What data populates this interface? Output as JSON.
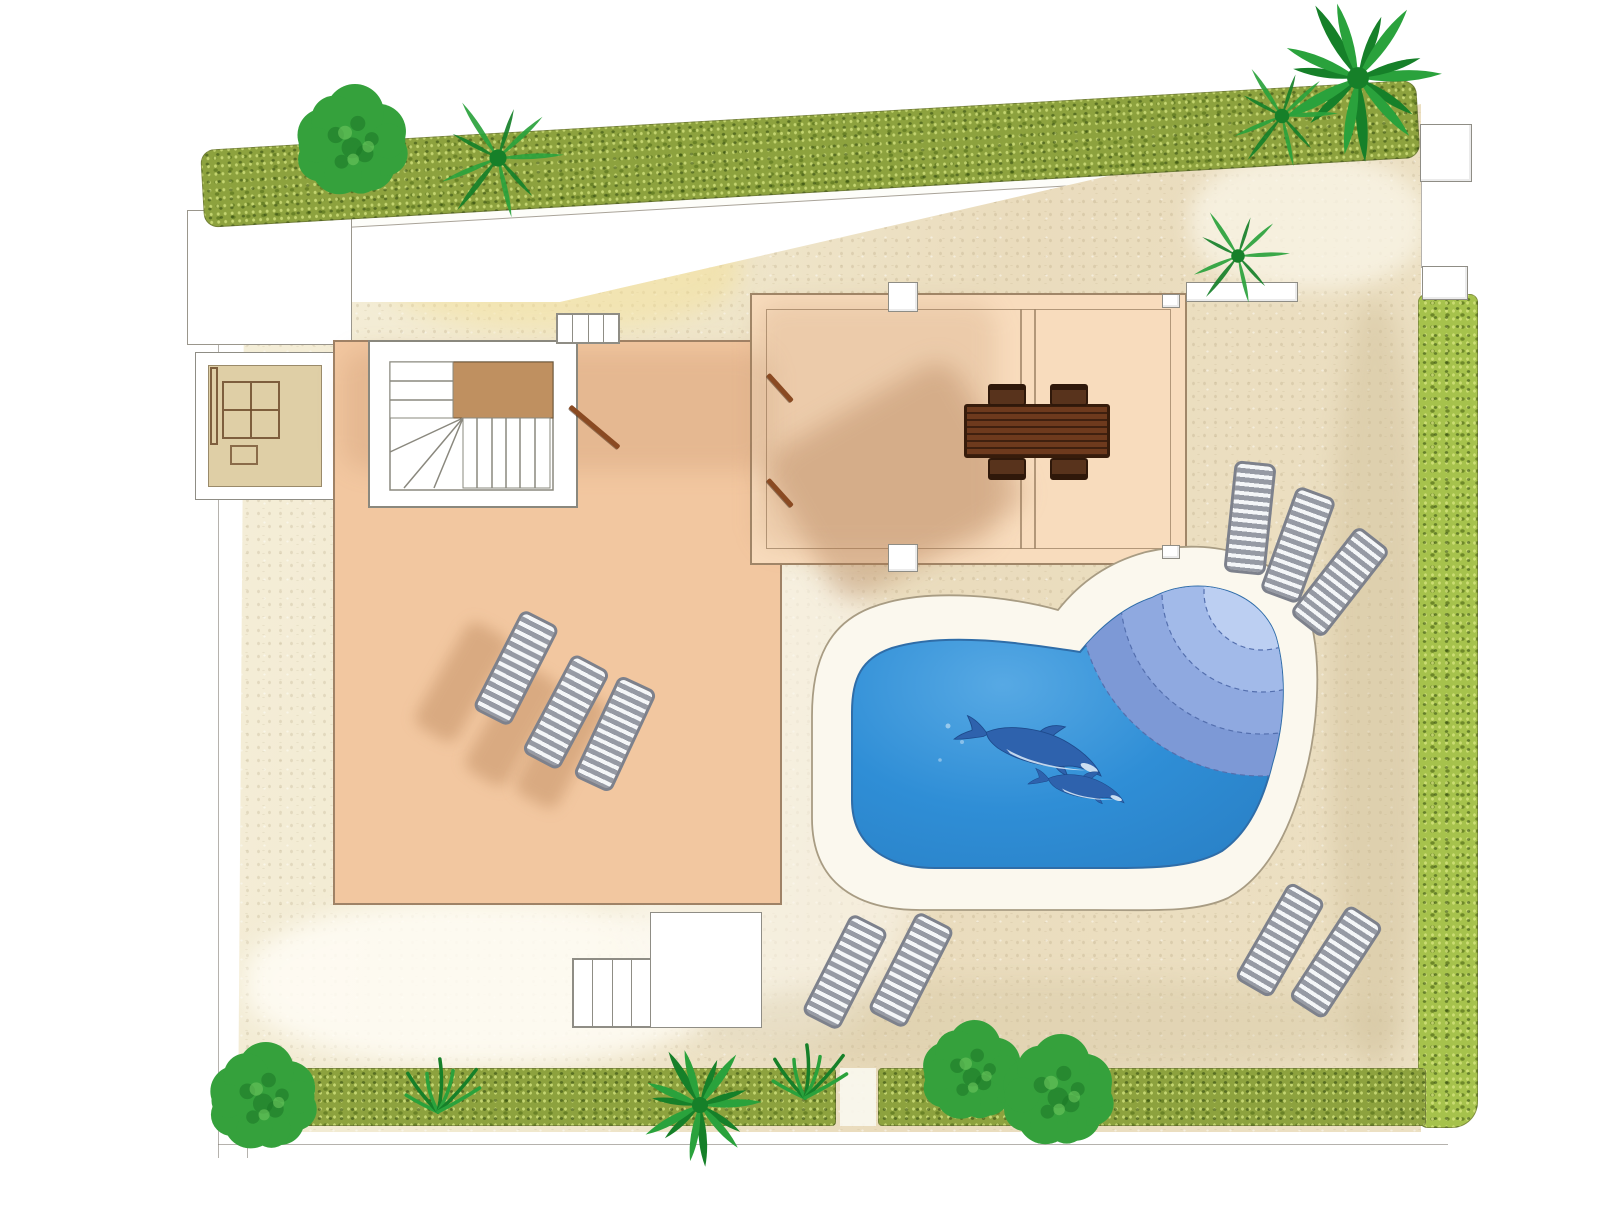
{
  "meta": {
    "view": "top-down-garden-plan",
    "text_labels": []
  },
  "colors": {
    "page": "#ffffff",
    "outline": "#8f8d85",
    "ground_light": "#f6f0dc",
    "ground_tan": "#e9dcbb",
    "terrace": "#f2c7a0",
    "pergola_floor": "#f8dcbd",
    "patio": "#ffffff",
    "stair_landing": "#bf9060",
    "bbq_interior": "#dfcfa6",
    "bbq_brown": "#6d4a2a",
    "pool_deck": "#fbf8ee",
    "pool_water": "#2f8ed6",
    "pool_water_light": "#57a9e4",
    "pool_edge": "#2f6da8",
    "step_arc_outer": "#7d99d6",
    "step_arc_2": "#8fa9e0",
    "step_arc_3": "#a2bae9",
    "step_arc_inner": "#bccff2",
    "dolphin": "#2e62ad",
    "dolphin_light": "#ddecf8",
    "hedge_olive": "#8da23e",
    "hedge_bright": "#a6c24c",
    "tree": "#35a13c",
    "tree_dark": "#1c7626",
    "tree_light": "#6cc65e",
    "palm": "#2aa23c",
    "palm_dark": "#168029",
    "lounger": "#969aa4",
    "lounger_stripe": "#f4f6f8",
    "table_wood": "#6e3a1d",
    "chair_wood": "#58331c",
    "shadow": "rgba(172,118,76,0.33)"
  },
  "scene": {
    "boundary_lines": [
      {
        "name": "boundary-left-outer",
        "x": 218,
        "y": 212,
        "w": 1,
        "h": 946
      },
      {
        "name": "boundary-left-inner",
        "x": 247,
        "y": 212,
        "w": 1,
        "h": 946
      },
      {
        "name": "boundary-bottom",
        "x": 218,
        "y": 1144,
        "w": 1230,
        "h": 1
      },
      {
        "name": "boundary-right-gate",
        "x": 1421,
        "y": 182,
        "w": 1,
        "h": 86
      }
    ],
    "hedges": [
      {
        "name": "hedge-north",
        "x": 200,
        "y": 150,
        "w": 1218,
        "h": 78,
        "rot": -3.3,
        "variant": "olive",
        "radius": "14px"
      },
      {
        "name": "hedge-east",
        "x": 1418,
        "y": 294,
        "w": 60,
        "h": 834,
        "rot": 0,
        "variant": "bright",
        "radius": "8px 8px 26px 10px"
      },
      {
        "name": "hedge-south-west",
        "x": 236,
        "y": 1068,
        "w": 600,
        "h": 58,
        "rot": 0,
        "variant": "olive",
        "radius": "10px 4px 4px 10px"
      },
      {
        "name": "hedge-south-east",
        "x": 878,
        "y": 1068,
        "w": 548,
        "h": 58,
        "rot": 0,
        "variant": "olive",
        "radius": "4px"
      }
    ],
    "posts": [
      {
        "name": "gate-post-north",
        "x": 1420,
        "y": 124,
        "w": 52,
        "h": 58
      },
      {
        "name": "gate-post-east",
        "x": 1422,
        "y": 266,
        "w": 46,
        "h": 34
      },
      {
        "name": "pergola-post-north",
        "x": 888,
        "y": 282,
        "w": 30,
        "h": 30
      },
      {
        "name": "pergola-post-south",
        "x": 888,
        "y": 544,
        "w": 30,
        "h": 28
      },
      {
        "name": "pergola-corner-ne",
        "x": 1162,
        "y": 294,
        "w": 18,
        "h": 14
      },
      {
        "name": "pergola-corner-se",
        "x": 1162,
        "y": 545,
        "w": 18,
        "h": 14
      },
      {
        "name": "palm-planter",
        "x": 1186,
        "y": 282,
        "w": 112,
        "h": 20
      }
    ],
    "tread_groups": [
      {
        "name": "steps-upper-terrace",
        "x": 556,
        "y": 313,
        "w": 64,
        "h": 31,
        "count": 4
      },
      {
        "name": "steps-lower-garden",
        "x": 572,
        "y": 958,
        "w": 80,
        "h": 70,
        "count": 4
      }
    ],
    "rails": [
      {
        "name": "handrail-stairs",
        "x": 570,
        "y": 404,
        "len": 64,
        "rot": 40
      },
      {
        "name": "handrail-pergola-upper",
        "x": 768,
        "y": 372,
        "len": 36,
        "rot": 48
      },
      {
        "name": "handrail-pergola-lower",
        "x": 768,
        "y": 477,
        "len": 36,
        "rot": 48
      }
    ],
    "chairs": [
      {
        "x": 988,
        "y": 384,
        "side": "top"
      },
      {
        "x": 1050,
        "y": 384,
        "side": "top"
      },
      {
        "x": 988,
        "y": 458,
        "side": "bottom"
      },
      {
        "x": 1050,
        "y": 458,
        "side": "bottom"
      }
    ],
    "loungers": [
      {
        "cx": 516,
        "cy": 668,
        "rot": 27
      },
      {
        "cx": 566,
        "cy": 712,
        "rot": 28
      },
      {
        "cx": 615,
        "cy": 734,
        "rot": 25
      },
      {
        "cx": 1250,
        "cy": 518,
        "rot": 6
      },
      {
        "cx": 1298,
        "cy": 545,
        "rot": 20
      },
      {
        "cx": 1340,
        "cy": 582,
        "rot": 38
      },
      {
        "cx": 845,
        "cy": 972,
        "rot": 27
      },
      {
        "cx": 911,
        "cy": 970,
        "rot": 27
      },
      {
        "cx": 1280,
        "cy": 940,
        "rot": 30
      },
      {
        "cx": 1336,
        "cy": 962,
        "rot": 33
      }
    ],
    "lounger_shadows": [
      {
        "cx": 462,
        "cy": 682,
        "rot": 30
      },
      {
        "cx": 512,
        "cy": 726,
        "rot": 30
      },
      {
        "cx": 561,
        "cy": 748,
        "rot": 28
      }
    ],
    "shadow_patches": [
      {
        "name": "table-shadow",
        "x": 788,
        "y": 396,
        "w": 215,
        "h": 170,
        "rot": -30,
        "o": 0.35
      },
      {
        "name": "pergola-west-shade",
        "x": 756,
        "y": 302,
        "w": 240,
        "h": 248,
        "rot": 0,
        "o": 0.16
      },
      {
        "name": "terrace-north-shade",
        "x": 342,
        "y": 350,
        "w": 430,
        "h": 120,
        "rot": 0,
        "o": 0.18
      }
    ],
    "ground_patches": [
      {
        "name": "wash-yellow-north",
        "x": 380,
        "y": 205,
        "w": 360,
        "h": 125,
        "c": "rgba(243,224,150,0.5)",
        "blur": 12
      },
      {
        "name": "wash-tan-bbq",
        "x": 318,
        "y": 352,
        "w": 145,
        "h": 155,
        "c": "rgba(196,170,118,0.45)",
        "blur": 8
      },
      {
        "name": "wash-bright-sw",
        "x": 245,
        "y": 900,
        "w": 480,
        "h": 165,
        "c": "rgba(255,253,246,0.85)",
        "blur": 12
      },
      {
        "name": "wash-light-mid",
        "x": 615,
        "y": 555,
        "w": 310,
        "h": 490,
        "c": "rgba(252,249,240,0.6)",
        "blur": 16
      },
      {
        "name": "wash-light-ne",
        "x": 1190,
        "y": 155,
        "w": 235,
        "h": 135,
        "c": "rgba(250,246,232,0.75)",
        "blur": 10
      },
      {
        "name": "wash-dark-east",
        "x": 1330,
        "y": 300,
        "w": 90,
        "h": 770,
        "c": "rgba(203,186,146,0.4)",
        "blur": 12
      },
      {
        "name": "wash-dark-south",
        "x": 700,
        "y": 980,
        "w": 700,
        "h": 90,
        "c": "rgba(210,195,158,0.35)",
        "blur": 12
      }
    ],
    "trees": [
      {
        "type": "fluffy",
        "name": "tree-northwest",
        "cx": 352,
        "cy": 142,
        "r": 58
      },
      {
        "type": "palm",
        "name": "palm-northwest",
        "cx": 498,
        "cy": 158,
        "r": 66,
        "sparse": true
      },
      {
        "type": "palm",
        "name": "palm-northeast-large",
        "cx": 1358,
        "cy": 78,
        "r": 84
      },
      {
        "type": "palm",
        "name": "palm-northeast-small",
        "cx": 1282,
        "cy": 116,
        "r": 56,
        "sparse": true
      },
      {
        "type": "palm",
        "name": "palm-courtyard",
        "cx": 1238,
        "cy": 256,
        "r": 52,
        "sparse": true
      },
      {
        "type": "fluffy",
        "name": "tree-southwest",
        "cx": 263,
        "cy": 1098,
        "r": 56
      },
      {
        "type": "palm",
        "name": "palm-south",
        "cx": 700,
        "cy": 1105,
        "r": 62
      },
      {
        "type": "fluffy",
        "name": "tree-south-1",
        "cx": 972,
        "cy": 1072,
        "r": 52
      },
      {
        "type": "fluffy",
        "name": "tree-south-2",
        "cx": 1058,
        "cy": 1092,
        "r": 58
      }
    ],
    "grass": [
      {
        "x": 805,
        "y": 1098
      },
      {
        "x": 438,
        "y": 1112
      }
    ],
    "dolphins": [
      {
        "x": 1045,
        "y": 750,
        "rot": 17,
        "scale": 0.85
      },
      {
        "x": 1087,
        "y": 788,
        "rot": 14,
        "scale": 0.55
      }
    ]
  }
}
